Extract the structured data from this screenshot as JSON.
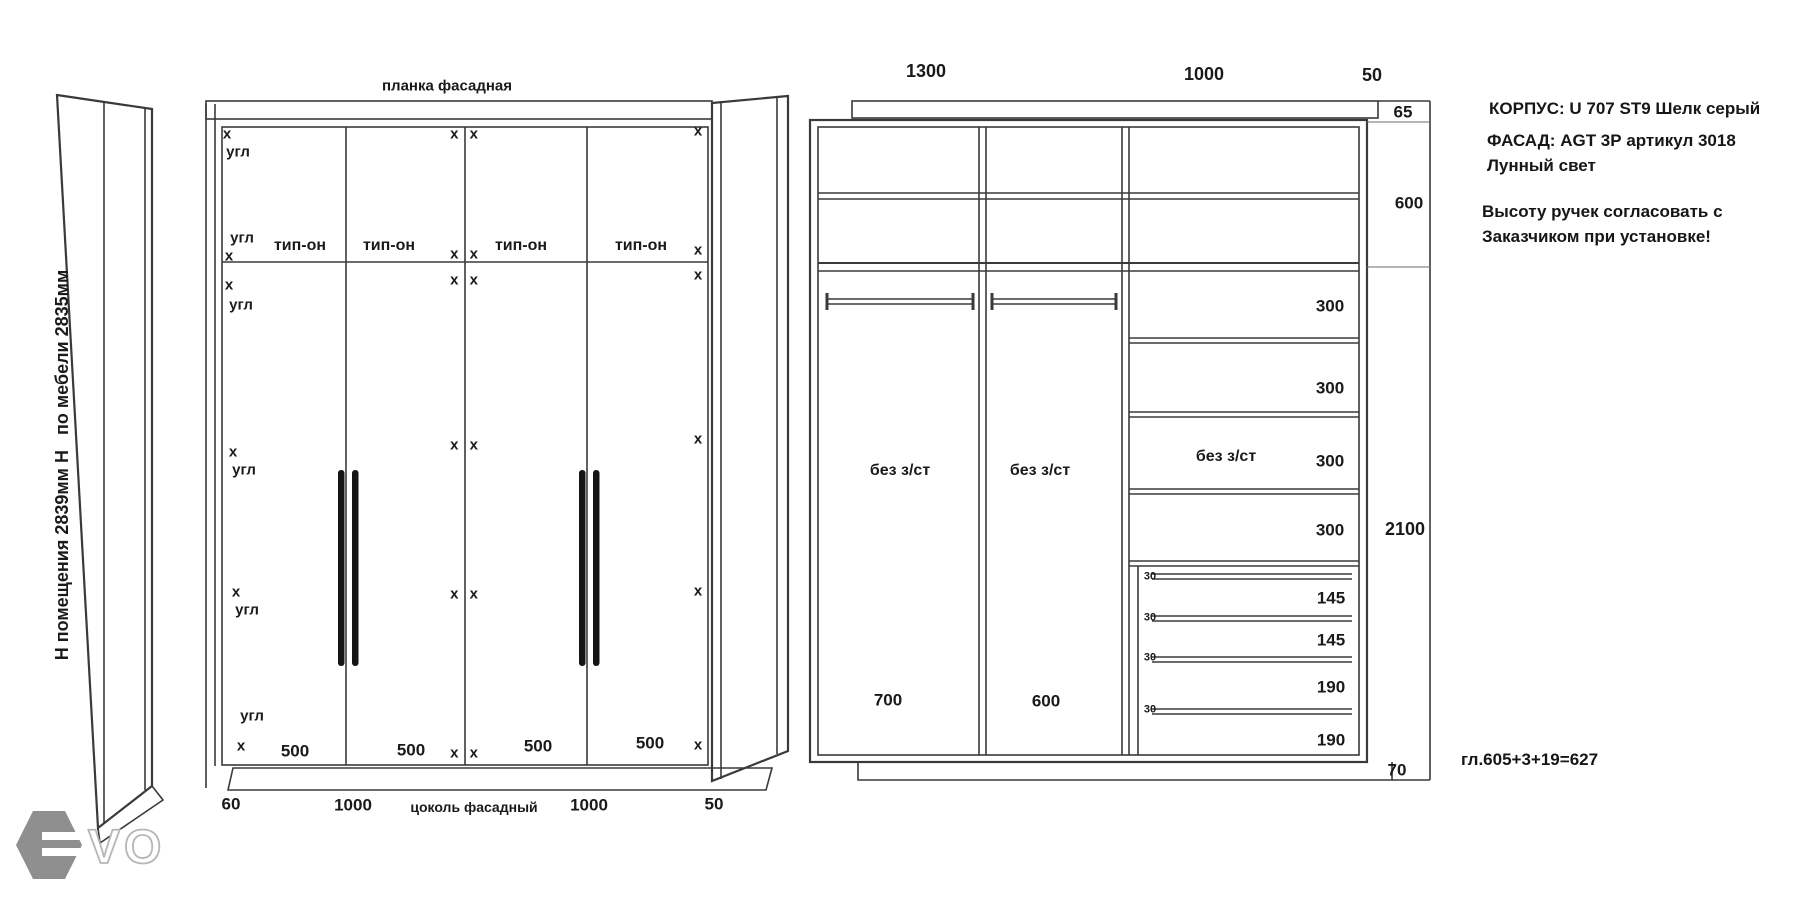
{
  "watermark": {
    "letters": "VO"
  },
  "left_view": {
    "top_label": "планка фасадная",
    "side_text": "Н помещения 2839мм Н   по мебели 2835мм",
    "hinge_label": "тип-он",
    "marker_x": "x",
    "marker_x_pair": "x x",
    "marker_corner": "угл",
    "door_width": "500",
    "plinth_label": "цоколь фасадный",
    "dim_left_gap": "60",
    "dim_door_pair_1": "1000",
    "dim_door_pair_2": "1000",
    "dim_right_gap": "50"
  },
  "right_view": {
    "dim_width_left": "1300",
    "dim_width_right": "1000",
    "dim_filler": "50",
    "dim_top_strip": "65",
    "dim_upper_section": "600",
    "dim_main_section": "2100",
    "dim_plinth": "70",
    "shelf_spacing": "300",
    "drawer_gap": "30",
    "drawer_h_small": "145",
    "drawer_h_large": "190",
    "no_backwall_label": "без з/ст",
    "comp_width_left": "700",
    "comp_width_middle": "600"
  },
  "notes": {
    "body_line": "КОРПУС: U 707 ST9 Шелк серый",
    "facade_line": "ФАСАД: AGT 3Р артикул 3018",
    "facade_line2": "Лунный свет",
    "handles_line1": "Высоту ручек согласовать с",
    "handles_line2": "Заказчиком при установке!",
    "depth_formula": "гл.605+3+19=627"
  }
}
